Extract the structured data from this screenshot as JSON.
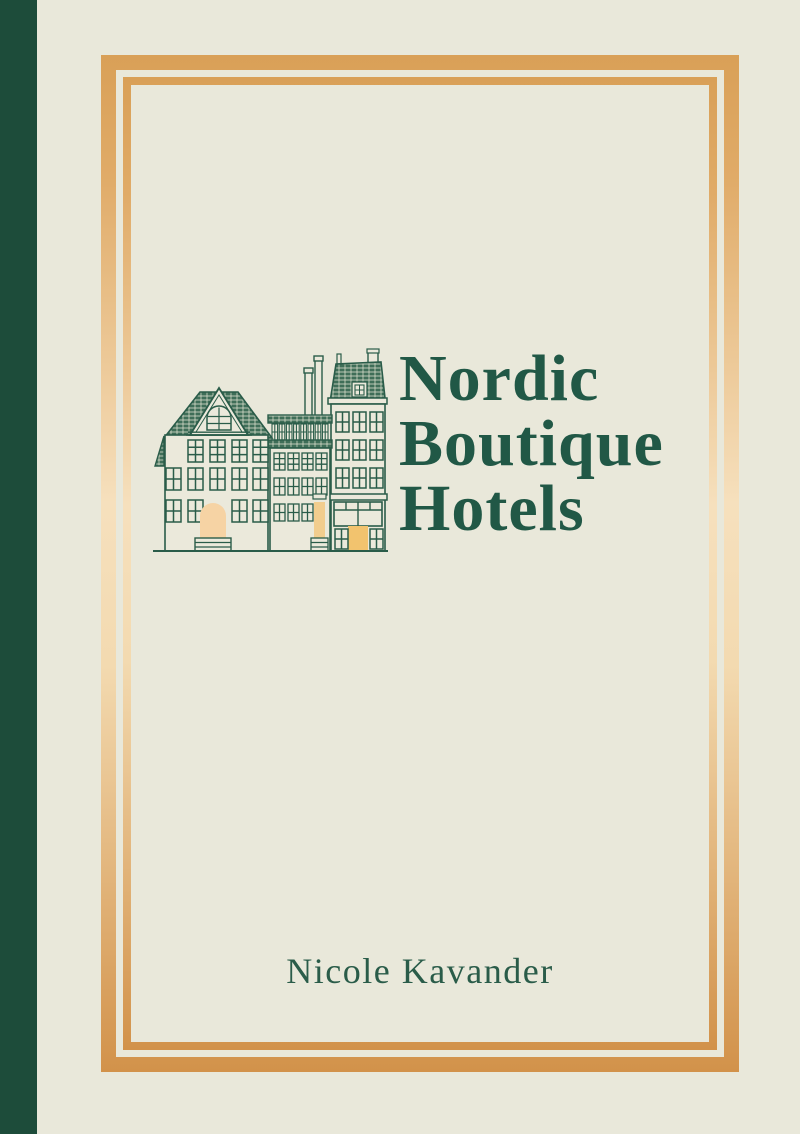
{
  "cover": {
    "title_lines": [
      "Nordic",
      "Boutique",
      "Hotels"
    ],
    "title_full": "Nordic Boutique Hotels",
    "author": "Nicole Kavander"
  },
  "colors": {
    "background": "#e9e8da",
    "spine_green": "#1d4c3a",
    "title_green": "#215846",
    "author_green": "#2a5c49",
    "illustration_line_green": "#2a5c49",
    "roof_tile_green": "#3f6e58",
    "gold_border_top": "#d9a057",
    "gold_border_middle": "#f6e0bd",
    "gold_border_bottom": "#d2924a",
    "door_peach": "#f6d3a4",
    "door_gold": "#f2c36e"
  },
  "illustration": {
    "name": "scandinavian-townhouses",
    "description": "Line drawing of three Nordic townhouses with tiled roofs, window grids and golden doors"
  }
}
